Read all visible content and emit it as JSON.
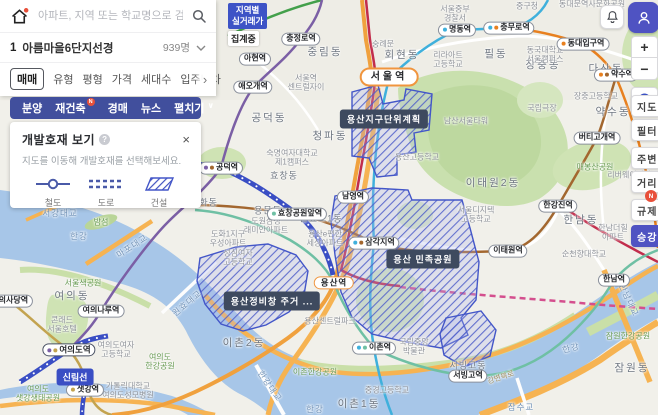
{
  "colors": {
    "accent": "#4f53c2",
    "nav_bar": "#414f9d",
    "dev_hatch": "#4356c8",
    "water": "#a7c6e8",
    "park": "#cfe3b4",
    "road_orange": "#f6b352",
    "badge_red": "#e8503a",
    "tooltip_bg": "#3e4a5f"
  },
  "search": {
    "placeholder": "아파트, 지역 또는 학교명으로 검색",
    "home_icon": "home-logo",
    "search_icon": "magnifier"
  },
  "complex_row": {
    "rank": "1",
    "name": "아름마을6단지선경",
    "count": "939명"
  },
  "filters": {
    "items": [
      "매매",
      "유형",
      "평형",
      "가격",
      "세대수",
      "입주년차"
    ],
    "selected": "매매",
    "more": "›"
  },
  "nav": {
    "items": [
      {
        "label": "분양"
      },
      {
        "label": "재건축",
        "badge": "N"
      },
      {
        "label": "경매"
      },
      {
        "label": "뉴스"
      },
      {
        "label": "펼치기",
        "chevron": "∨"
      }
    ]
  },
  "dev_panel": {
    "title": "개발호재 보기",
    "help": "?",
    "close": "×",
    "subtitle": "지도를 이동해 개발호재를 선택해보세요.",
    "legend": [
      {
        "label": "철도",
        "icon": "rail-line-icon"
      },
      {
        "label": "도로",
        "icon": "road-dash-icon"
      },
      {
        "label": "건설",
        "icon": "construction-hatch-icon"
      }
    ]
  },
  "region_badge": {
    "line1": "지역별",
    "line2": "실거래가",
    "status": "집계중"
  },
  "toolbar": {
    "zoom_in": "+",
    "zoom_out": "−",
    "buttons": [
      {
        "label": "지도",
        "y": 95
      },
      {
        "label": "필터",
        "y": 119
      },
      {
        "label": "주변",
        "y": 147
      },
      {
        "label": "거리",
        "y": 171
      },
      {
        "label": "규제",
        "y": 199,
        "badge": "N"
      },
      {
        "label": "승강",
        "y": 225,
        "active": true
      }
    ]
  },
  "map": {
    "tooltips": [
      {
        "t": "용산지구단위계획",
        "x": 384,
        "y": 119
      },
      {
        "t": "용산 민족공원",
        "x": 423,
        "y": 259
      },
      {
        "t": "용산정비창 주거 ...",
        "x": 272,
        "y": 301
      }
    ],
    "line_pills": [
      {
        "t": "신림선",
        "x": 75,
        "y": 377
      }
    ],
    "stations": [
      {
        "t": "서울역",
        "x": 389,
        "y": 77,
        "s": "major"
      },
      {
        "t": "용산역",
        "x": 334,
        "y": 283,
        "s": "major2"
      },
      {
        "t": "여의도역",
        "x": 69,
        "y": 350,
        "s": "hub",
        "d": [
          "#7b5fa5",
          "#c3a34f"
        ]
      },
      {
        "t": "공덕역",
        "x": 221,
        "y": 168,
        "d": [
          "#7b5fa5",
          "#a3672f"
        ]
      },
      {
        "t": "효창공원앞역",
        "x": 297,
        "y": 214,
        "d": [
          "#6fc0a4"
        ]
      },
      {
        "t": "남영역",
        "x": 353,
        "y": 197
      },
      {
        "t": "삼각지역",
        "x": 374,
        "y": 243,
        "d": [
          "#3fb0dc",
          "#a3672f"
        ]
      },
      {
        "t": "아현역",
        "x": 255,
        "y": 59
      },
      {
        "t": "충정로역",
        "x": 301,
        "y": 39
      },
      {
        "t": "애오개역",
        "x": 253,
        "y": 87
      },
      {
        "t": "명동역",
        "x": 457,
        "y": 30,
        "d": [
          "#3fb0dc"
        ]
      },
      {
        "t": "충무로역",
        "x": 509,
        "y": 28,
        "d": [
          "#3fb0dc",
          "#e8801f"
        ]
      },
      {
        "t": "동대입구역",
        "x": 583,
        "y": 44,
        "d": [
          "#e8801f"
        ]
      },
      {
        "t": "약수역",
        "x": 616,
        "y": 75,
        "d": [
          "#e8801f",
          "#a3672f"
        ]
      },
      {
        "t": "버티고개역",
        "x": 597,
        "y": 138
      },
      {
        "t": "한강진역",
        "x": 558,
        "y": 206
      },
      {
        "t": "이태원역",
        "x": 508,
        "y": 251
      },
      {
        "t": "이촌역",
        "x": 374,
        "y": 348,
        "d": [
          "#3fb0dc",
          "#6fc0a4"
        ]
      },
      {
        "t": "서빙고역",
        "x": 468,
        "y": 376
      },
      {
        "t": "한남역",
        "x": 614,
        "y": 280
      },
      {
        "t": "여의나루역",
        "x": 101,
        "y": 311
      },
      {
        "t": "샛강역",
        "x": 85,
        "y": 390,
        "d": [
          "#c3a34f"
        ]
      },
      {
        "t": "국회의사당역",
        "x": 6,
        "y": 301
      }
    ],
    "labels": [
      {
        "t": "중림동",
        "x": 325,
        "y": 52,
        "c": "area"
      },
      {
        "t": "회현동",
        "x": 402,
        "y": 55,
        "c": "area"
      },
      {
        "t": "필동",
        "x": 496,
        "y": 54,
        "c": "area"
      },
      {
        "t": "장충동",
        "x": 543,
        "y": 65,
        "c": "area"
      },
      {
        "t": "다산동",
        "x": 606,
        "y": 69,
        "c": "area"
      },
      {
        "t": "약수동",
        "x": 613,
        "y": 112,
        "c": "area"
      },
      {
        "t": "후암동",
        "x": 410,
        "y": 119,
        "c": "area"
      },
      {
        "t": "청파동",
        "x": 330,
        "y": 136,
        "c": "area"
      },
      {
        "t": "공덕동",
        "x": 269,
        "y": 118,
        "c": "area"
      },
      {
        "t": "이태원2동",
        "x": 493,
        "y": 183,
        "c": "area"
      },
      {
        "t": "한남동",
        "x": 581,
        "y": 220,
        "c": "area"
      },
      {
        "t": "원효로1동",
        "x": 321,
        "y": 219,
        "c": "area-sm"
      },
      {
        "t": "효창동",
        "x": 284,
        "y": 176,
        "c": "area-sm"
      },
      {
        "t": "용문동",
        "x": 268,
        "y": 211,
        "c": "area-sm"
      },
      {
        "t": "도화동",
        "x": 204,
        "y": 203,
        "c": "area-sm"
      },
      {
        "t": "이촌2동",
        "x": 244,
        "y": 343,
        "c": "area"
      },
      {
        "t": "이촌1동",
        "x": 359,
        "y": 404,
        "c": "area"
      },
      {
        "t": "여의동",
        "x": 72,
        "y": 296,
        "c": "area"
      },
      {
        "t": "잠원동",
        "x": 632,
        "y": 368,
        "c": "area"
      },
      {
        "t": "서빙고동",
        "x": 468,
        "y": 366,
        "c": "area-sm"
      },
      {
        "t": "서울중부\n경찰서",
        "x": 455,
        "y": 14,
        "c": "poi"
      },
      {
        "t": "중구청",
        "x": 527,
        "y": 6,
        "c": "poi"
      },
      {
        "t": "숭례문",
        "x": 383,
        "y": 44,
        "c": "poi"
      },
      {
        "t": "동대문역사문화공원",
        "x": 592,
        "y": 4,
        "c": "poi"
      },
      {
        "t": "리라아트\n고등학교",
        "x": 448,
        "y": 60,
        "c": "poi"
      },
      {
        "t": "동국대학교\n서울캠퍼스",
        "x": 545,
        "y": 55,
        "c": "poi"
      },
      {
        "t": "국립극장",
        "x": 542,
        "y": 108,
        "c": "poi"
      },
      {
        "t": "남산서울타워",
        "x": 466,
        "y": 121,
        "c": "poi"
      },
      {
        "t": "장충고등학교",
        "x": 596,
        "y": 96,
        "c": "poi"
      },
      {
        "t": "용산고등학교",
        "x": 417,
        "y": 157,
        "c": "poi"
      },
      {
        "t": "숙명여자대학교\n제1캠퍼스",
        "x": 292,
        "y": 158,
        "c": "poi"
      },
      {
        "t": "서울역\n센트럴자이",
        "x": 306,
        "y": 83,
        "c": "poi"
      },
      {
        "t": "서울디지텍\n고등학교",
        "x": 476,
        "y": 215,
        "c": "poi"
      },
      {
        "t": "한남더힐\n아파트",
        "x": 613,
        "y": 233,
        "c": "poi"
      },
      {
        "t": "리버웨이아파트",
        "x": 633,
        "y": 175,
        "c": "poi"
      },
      {
        "t": "순천향대학교",
        "x": 584,
        "y": 254,
        "c": "poi"
      },
      {
        "t": "가톨릭대학교\n여의도성모병원",
        "x": 128,
        "y": 391,
        "c": "poi"
      },
      {
        "t": "여의도여자\n고등학교",
        "x": 116,
        "y": 350,
        "c": "poi"
      },
      {
        "t": "콘래드\n서울호텔",
        "x": 62,
        "y": 325,
        "c": "poi"
      },
      {
        "t": "국립중앙\n박물관",
        "x": 414,
        "y": 347,
        "c": "poi"
      },
      {
        "t": "중경고등학교",
        "x": 387,
        "y": 390,
        "c": "poi"
      },
      {
        "t": "용산e편한\n세상아파트",
        "x": 325,
        "y": 239,
        "c": "poi"
      },
      {
        "t": "도화1지구\n우성아파트",
        "x": 228,
        "y": 239,
        "c": "poi"
      },
      {
        "t": "성심여자\n고등학교",
        "x": 238,
        "y": 258,
        "c": "poi"
      },
      {
        "t": "도원삼성\n래미안아파트",
        "x": 266,
        "y": 226,
        "c": "poi"
      },
      {
        "t": "용산센트럴파크",
        "x": 330,
        "y": 321,
        "c": "poi"
      },
      {
        "t": "매봉산공원",
        "x": 595,
        "y": 167,
        "c": "park"
      },
      {
        "t": "백범광장공원",
        "x": 392,
        "y": 74,
        "c": "park"
      },
      {
        "t": "이촌한강공원",
        "x": 315,
        "y": 372,
        "c": "park"
      },
      {
        "t": "잠원한강공원",
        "x": 628,
        "y": 336,
        "c": "park"
      },
      {
        "t": "서울색공원",
        "x": 83,
        "y": 283,
        "c": "park"
      },
      {
        "t": "여의도\n샛강생태공원",
        "x": 38,
        "y": 394,
        "c": "park"
      },
      {
        "t": "여의도\n한강공원",
        "x": 160,
        "y": 362,
        "c": "park"
      },
      {
        "t": "밤섬",
        "x": 101,
        "y": 222,
        "c": "park"
      },
      {
        "t": "서강대교",
        "x": 60,
        "y": 213,
        "c": "water"
      },
      {
        "t": "마포대교",
        "x": 132,
        "y": 246,
        "c": "water",
        "r": -33
      },
      {
        "t": "원효대교",
        "x": 187,
        "y": 303,
        "c": "water",
        "r": -40
      },
      {
        "t": "한강대교",
        "x": 270,
        "y": 386,
        "c": "water",
        "r": 55
      },
      {
        "t": "한남대교",
        "x": 629,
        "y": 300,
        "c": "water",
        "r": 65
      },
      {
        "t": "잠수교",
        "x": 521,
        "y": 407,
        "c": "water"
      },
      {
        "t": "한강",
        "x": 315,
        "y": 409,
        "c": "water"
      },
      {
        "t": "한강",
        "x": 571,
        "y": 348,
        "c": "water",
        "r": -15
      },
      {
        "t": "한강",
        "x": 79,
        "y": 236,
        "c": "water"
      },
      {
        "t": "강변북로",
        "x": 501,
        "y": 378,
        "c": "roadlbl",
        "r": -18
      }
    ]
  }
}
